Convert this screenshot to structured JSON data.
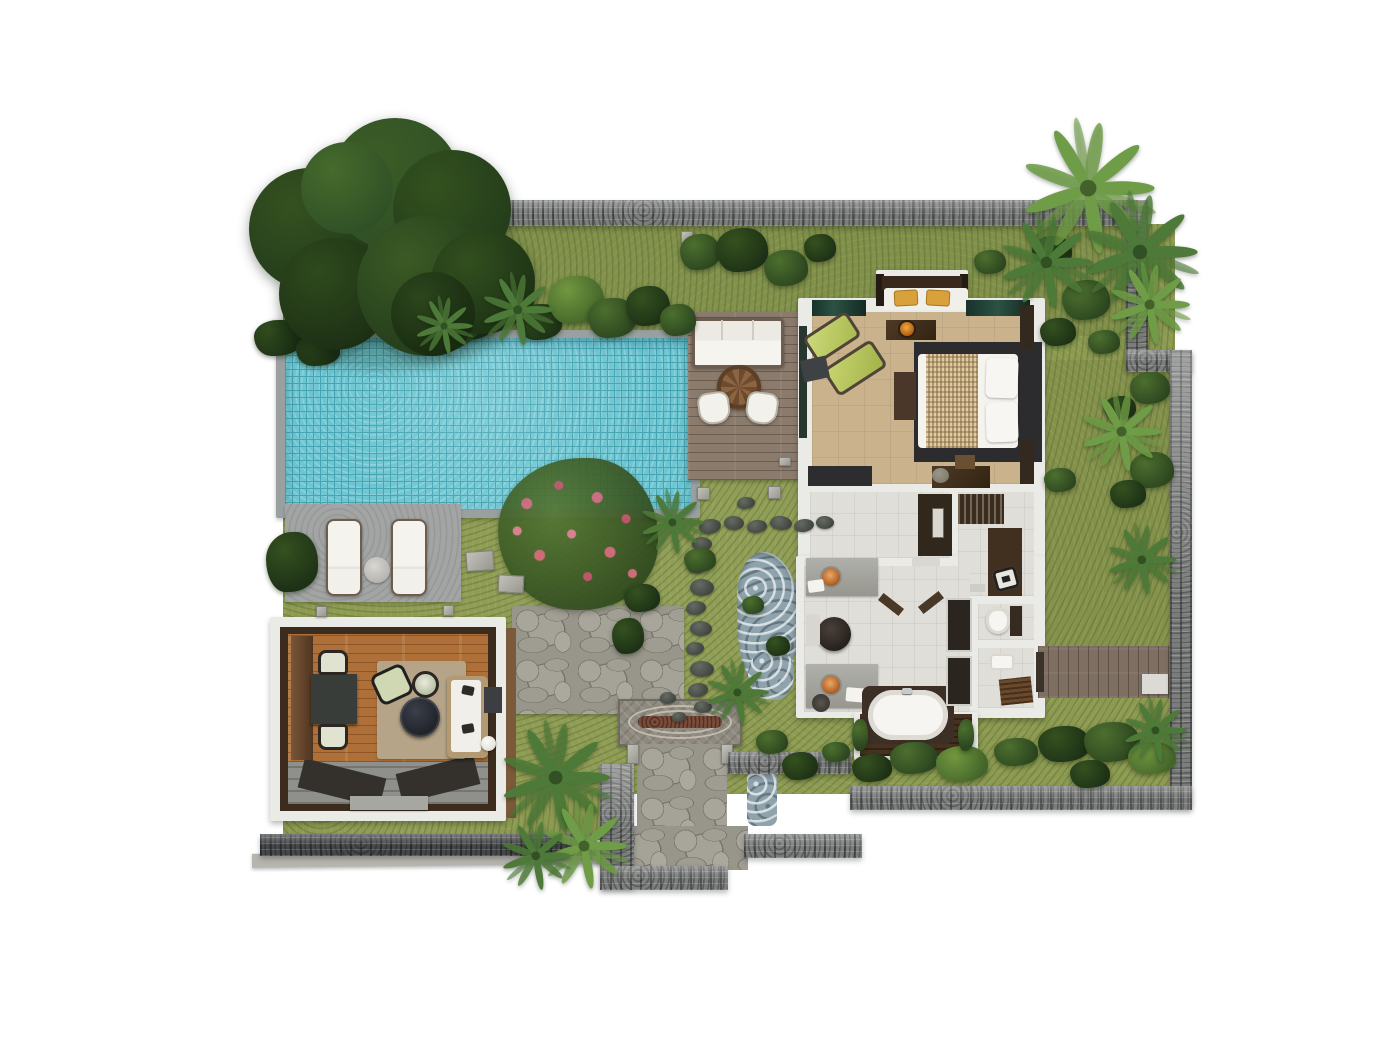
{
  "title": "Tropical Pool Villa – Top-View Floor Plan",
  "palette": {
    "grass": "#8c9a52",
    "grassShade": "#74843e",
    "pool": "#6ec6d2",
    "poolLine": "#46a5b2",
    "coping": "#9aa0a0",
    "deckConcrete": "#a2a5a4",
    "wallStone": "#7b7e7c",
    "wallDark": "#45484a",
    "wallLight": "#b7b5ae",
    "deckWood": "#8b7b6d",
    "walkWood": "#7e6f62",
    "pavWood": "#ae7038",
    "roofBrown": "#3c2c1e",
    "fascia": "#7a5a3a",
    "frameWhite": "#eaeae7",
    "rug": "#b5a488",
    "charcoal": "#2e2e31",
    "woodDark": "#43301f",
    "bedFloor": "#c9b28c",
    "tile": "#e0ded8",
    "counter": "#a5a5a1",
    "copper": "#c67c45",
    "waterBlue": "#8fa3ad",
    "stoneDark": "#4b504b",
    "flagstone": "#98958b",
    "pavePad": "#8e8a80",
    "brick": "#7b4c39",
    "treeDark": "#233c1c",
    "treeMid": "#2f5026",
    "leafLight": "#6f9c46",
    "leafMid": "#4d7a38",
    "lime": "#c3d168",
    "gold": "#d8a13b",
    "pink": "#d4687c",
    "white": "#f2f1ec"
  },
  "areas": {
    "pool": {
      "label": "Swimming pool"
    },
    "pool_deck": {
      "label": "Pool deck with sun loungers"
    },
    "sun_deck": {
      "label": "Outdoor lounge deck"
    },
    "pavilion": {
      "label": "Open-air living pavilion"
    },
    "bedroom": {
      "label": "Bedroom"
    },
    "dressing": {
      "label": "Dressing area"
    },
    "bathroom": {
      "label": "Bathroom"
    },
    "entrance": {
      "label": "Entrance court"
    },
    "garden": {
      "label": "Walled tropical garden"
    },
    "stream": {
      "label": "Rock water feature"
    },
    "walkway": {
      "label": "Timber side walkway"
    },
    "tree": {
      "label": "Large shade tree"
    }
  },
  "garden": {
    "bushes": [
      {
        "x": 470,
        "y": 318,
        "rx": 26,
        "ry": 22,
        "tone": "d"
      },
      {
        "x": 508,
        "y": 300,
        "rx": 26,
        "ry": 24,
        "tone": "m"
      },
      {
        "x": 540,
        "y": 322,
        "rx": 22,
        "ry": 18,
        "tone": "d"
      },
      {
        "x": 576,
        "y": 300,
        "rx": 28,
        "ry": 24,
        "tone": "l"
      },
      {
        "x": 612,
        "y": 318,
        "rx": 24,
        "ry": 20,
        "tone": "m"
      },
      {
        "x": 648,
        "y": 306,
        "rx": 22,
        "ry": 20,
        "tone": "d"
      },
      {
        "x": 678,
        "y": 320,
        "rx": 18,
        "ry": 16,
        "tone": "m"
      },
      {
        "x": 700,
        "y": 252,
        "rx": 20,
        "ry": 18,
        "tone": "m"
      },
      {
        "x": 742,
        "y": 250,
        "rx": 26,
        "ry": 22,
        "tone": "d"
      },
      {
        "x": 786,
        "y": 268,
        "rx": 22,
        "ry": 18,
        "tone": "m"
      },
      {
        "x": 820,
        "y": 248,
        "rx": 16,
        "ry": 14,
        "tone": "d"
      },
      {
        "x": 278,
        "y": 338,
        "rx": 24,
        "ry": 18,
        "tone": "d"
      },
      {
        "x": 318,
        "y": 350,
        "rx": 22,
        "ry": 16,
        "tone": "d"
      },
      {
        "x": 292,
        "y": 562,
        "rx": 26,
        "ry": 30,
        "tone": "d"
      },
      {
        "x": 642,
        "y": 598,
        "rx": 18,
        "ry": 14,
        "tone": "d"
      },
      {
        "x": 628,
        "y": 636,
        "rx": 16,
        "ry": 18,
        "tone": "d"
      },
      {
        "x": 700,
        "y": 560,
        "rx": 16,
        "ry": 12,
        "tone": "m"
      },
      {
        "x": 1052,
        "y": 252,
        "rx": 20,
        "ry": 16,
        "tone": "d"
      },
      {
        "x": 1086,
        "y": 300,
        "rx": 24,
        "ry": 20,
        "tone": "m"
      },
      {
        "x": 1058,
        "y": 332,
        "rx": 18,
        "ry": 14,
        "tone": "d"
      },
      {
        "x": 1104,
        "y": 342,
        "rx": 16,
        "ry": 12,
        "tone": "m"
      },
      {
        "x": 990,
        "y": 262,
        "rx": 16,
        "ry": 12,
        "tone": "m"
      },
      {
        "x": 1060,
        "y": 480,
        "rx": 16,
        "ry": 12,
        "tone": "m"
      },
      {
        "x": 1152,
        "y": 470,
        "rx": 22,
        "ry": 18,
        "tone": "m"
      },
      {
        "x": 1128,
        "y": 494,
        "rx": 18,
        "ry": 14,
        "tone": "d"
      },
      {
        "x": 872,
        "y": 768,
        "rx": 20,
        "ry": 14,
        "tone": "d"
      },
      {
        "x": 914,
        "y": 758,
        "rx": 24,
        "ry": 16,
        "tone": "m"
      },
      {
        "x": 962,
        "y": 764,
        "rx": 26,
        "ry": 18,
        "tone": "l"
      },
      {
        "x": 1016,
        "y": 752,
        "rx": 22,
        "ry": 14,
        "tone": "m"
      },
      {
        "x": 1064,
        "y": 744,
        "rx": 26,
        "ry": 18,
        "tone": "d"
      },
      {
        "x": 1112,
        "y": 742,
        "rx": 28,
        "ry": 20,
        "tone": "m"
      },
      {
        "x": 1152,
        "y": 758,
        "rx": 24,
        "ry": 16,
        "tone": "l"
      },
      {
        "x": 1090,
        "y": 774,
        "rx": 20,
        "ry": 14,
        "tone": "d"
      },
      {
        "x": 772,
        "y": 742,
        "rx": 16,
        "ry": 12,
        "tone": "m"
      },
      {
        "x": 800,
        "y": 766,
        "rx": 18,
        "ry": 14,
        "tone": "d"
      },
      {
        "x": 836,
        "y": 752,
        "rx": 14,
        "ry": 10,
        "tone": "m"
      },
      {
        "x": 860,
        "y": 735,
        "rx": 8,
        "ry": 16,
        "tone": "m"
      },
      {
        "x": 966,
        "y": 735,
        "rx": 8,
        "ry": 16,
        "tone": "m"
      },
      {
        "x": 1150,
        "y": 388,
        "rx": 20,
        "ry": 16,
        "tone": "m"
      },
      {
        "x": 1120,
        "y": 408,
        "rx": 16,
        "ry": 12,
        "tone": "d"
      }
    ],
    "palms": [
      {
        "x": 1088,
        "y": 188,
        "s": 1.15,
        "tone": "l"
      },
      {
        "x": 1140,
        "y": 252,
        "s": 1.0,
        "tone": "m"
      },
      {
        "x": 1046,
        "y": 262,
        "s": 0.8,
        "tone": "m"
      },
      {
        "x": 1150,
        "y": 305,
        "s": 0.7,
        "tone": "l"
      },
      {
        "x": 518,
        "y": 310,
        "s": 0.62,
        "tone": "m"
      },
      {
        "x": 444,
        "y": 326,
        "s": 0.5,
        "tone": "m"
      },
      {
        "x": 672,
        "y": 522,
        "s": 0.55,
        "tone": "m"
      },
      {
        "x": 556,
        "y": 778,
        "s": 0.95,
        "tone": "m"
      },
      {
        "x": 584,
        "y": 846,
        "s": 0.75,
        "tone": "l"
      },
      {
        "x": 536,
        "y": 856,
        "s": 0.6,
        "tone": "m"
      },
      {
        "x": 737,
        "y": 692,
        "s": 0.55,
        "tone": "m"
      },
      {
        "x": 1142,
        "y": 560,
        "s": 0.6,
        "tone": "m"
      },
      {
        "x": 1122,
        "y": 432,
        "s": 0.7,
        "tone": "l"
      },
      {
        "x": 1155,
        "y": 730,
        "s": 0.55,
        "tone": "m"
      }
    ],
    "stones": [
      {
        "x": 699,
        "y": 519,
        "w": 22,
        "h": 15,
        "r": -8
      },
      {
        "x": 724,
        "y": 516,
        "w": 20,
        "h": 14,
        "r": 6
      },
      {
        "x": 747,
        "y": 520,
        "w": 20,
        "h": 13,
        "r": -5
      },
      {
        "x": 770,
        "y": 516,
        "w": 22,
        "h": 14,
        "r": 8
      },
      {
        "x": 794,
        "y": 519,
        "w": 20,
        "h": 13,
        "r": -6
      },
      {
        "x": 816,
        "y": 516,
        "w": 18,
        "h": 13,
        "r": 5
      },
      {
        "x": 692,
        "y": 537,
        "w": 20,
        "h": 14,
        "r": 4
      },
      {
        "x": 687,
        "y": 557,
        "w": 22,
        "h": 16,
        "r": -6
      },
      {
        "x": 690,
        "y": 579,
        "w": 24,
        "h": 17,
        "r": 5
      },
      {
        "x": 686,
        "y": 601,
        "w": 20,
        "h": 14,
        "r": -4
      },
      {
        "x": 690,
        "y": 621,
        "w": 22,
        "h": 15,
        "r": 6
      },
      {
        "x": 686,
        "y": 642,
        "w": 18,
        "h": 13,
        "r": -5
      },
      {
        "x": 690,
        "y": 661,
        "w": 24,
        "h": 16,
        "r": 4
      },
      {
        "x": 688,
        "y": 683,
        "w": 20,
        "h": 14,
        "r": -6
      },
      {
        "x": 694,
        "y": 701,
        "w": 18,
        "h": 12,
        "r": 3
      },
      {
        "x": 737,
        "y": 497,
        "w": 18,
        "h": 12,
        "r": -4
      },
      {
        "x": 660,
        "y": 692,
        "w": 16,
        "h": 12,
        "r": 5
      },
      {
        "x": 672,
        "y": 712,
        "w": 14,
        "h": 10,
        "r": -4
      }
    ],
    "pads": [
      {
        "x": 466,
        "y": 551,
        "w": 28,
        "h": 20,
        "r": -4
      },
      {
        "x": 498,
        "y": 575,
        "w": 26,
        "h": 18,
        "r": 3
      },
      {
        "x": 697,
        "y": 487,
        "w": 13,
        "h": 13,
        "r": 0
      },
      {
        "x": 768,
        "y": 486,
        "w": 13,
        "h": 13,
        "r": 0
      },
      {
        "x": 681,
        "y": 231,
        "w": 12,
        "h": 12,
        "r": 0
      },
      {
        "x": 779,
        "y": 457,
        "w": 12,
        "h": 9,
        "r": 0
      }
    ]
  }
}
